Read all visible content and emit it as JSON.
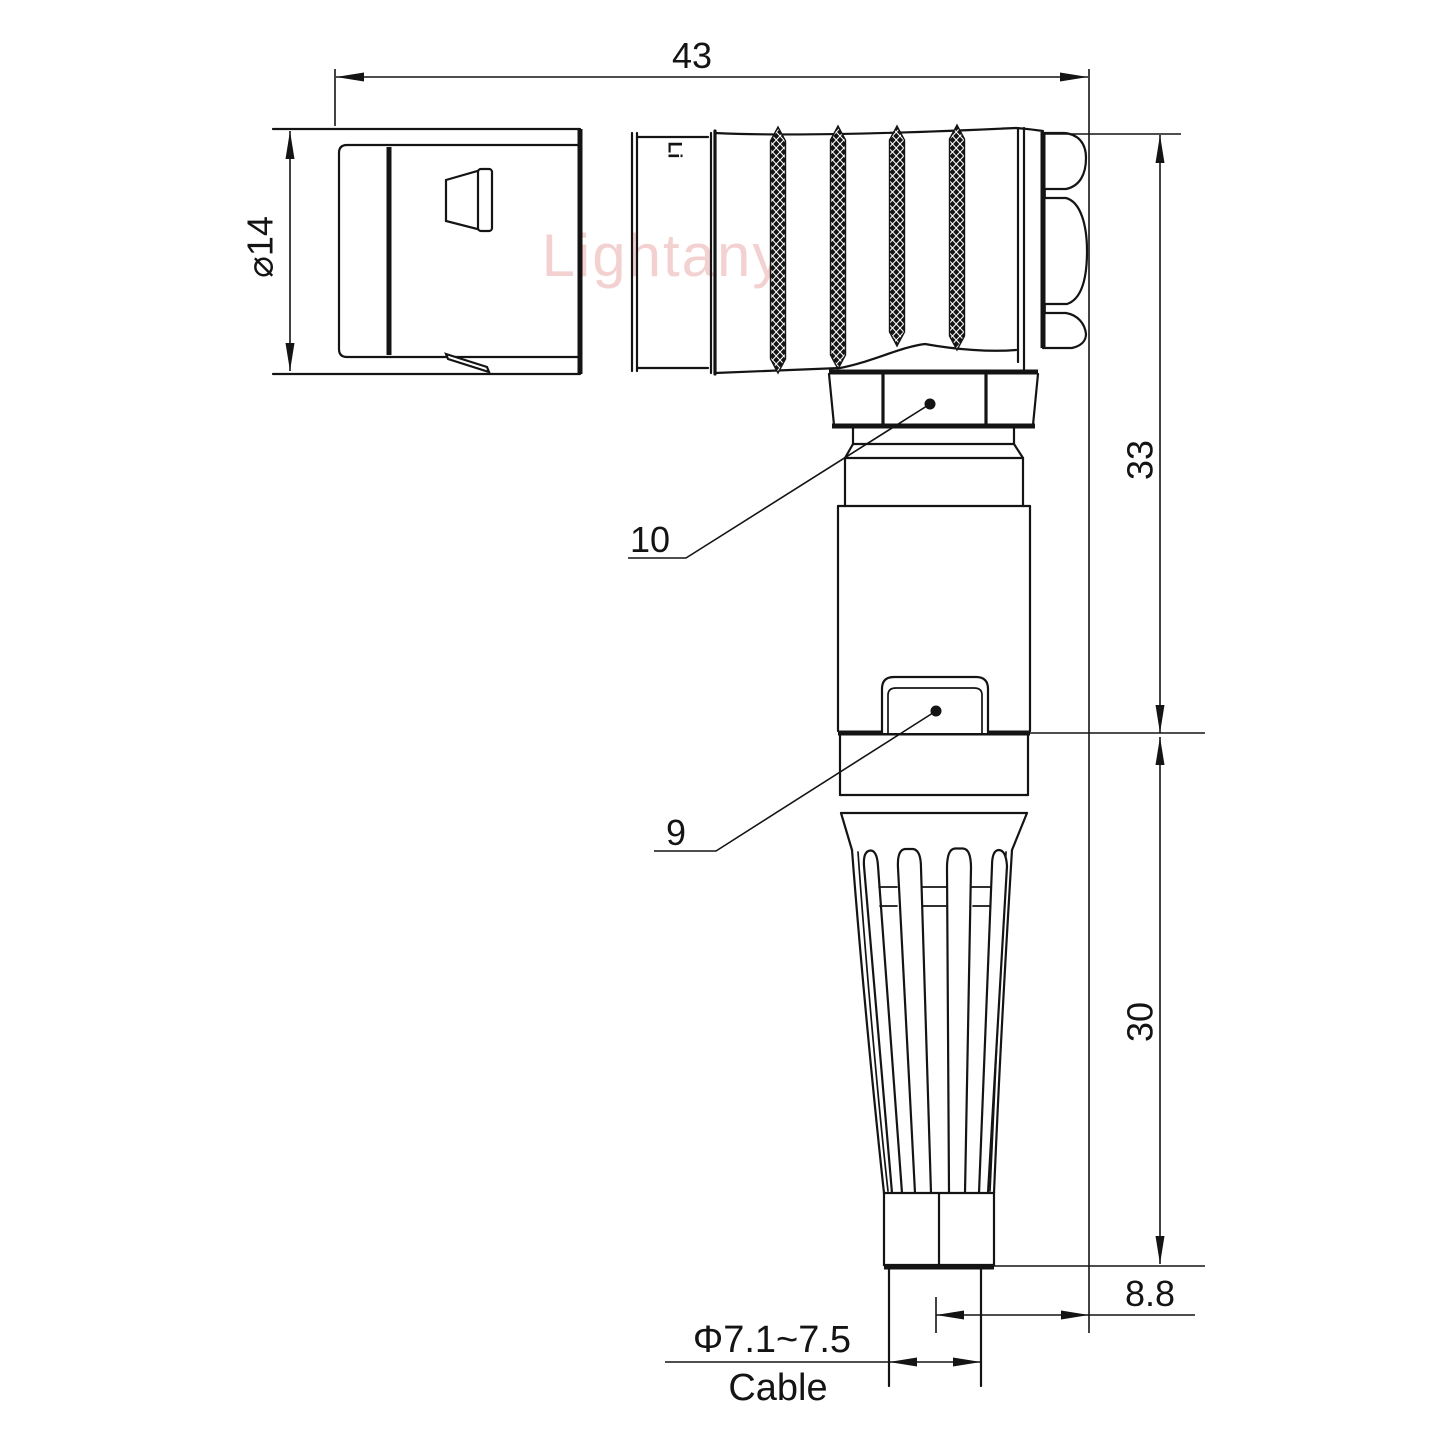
{
  "drawing": {
    "background": "#ffffff",
    "line_color": "#141414",
    "watermark": {
      "text": "Lightany",
      "color": "#e58f8f"
    },
    "body_marking": {
      "text": "Li"
    },
    "dimensions": {
      "overall_length": "43",
      "plug_diameter": "⌀14",
      "upper_height": "33",
      "lower_height": "30",
      "axis_offset": "8.8",
      "cable_diameter": "Φ7.1~7.5",
      "cable_word": "Cable"
    },
    "part_labels": {
      "coupling_nut": "10",
      "clip": "9"
    }
  }
}
